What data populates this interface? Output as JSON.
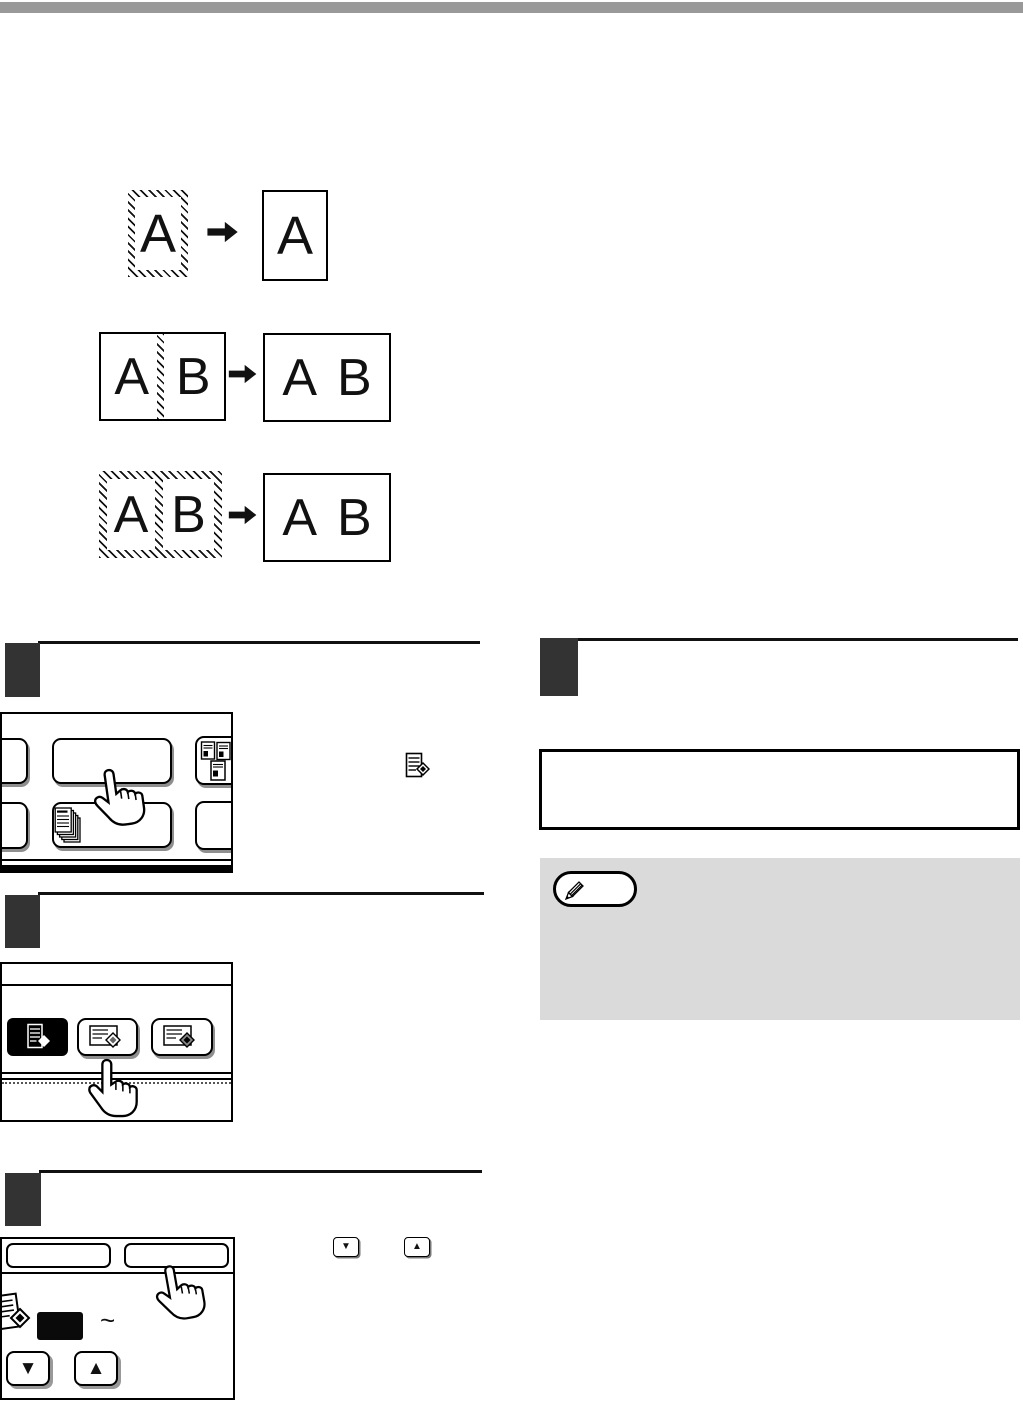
{
  "page": {
    "background": "#ffffff",
    "top_bar_color": "#999999",
    "step_marker_color": "#333333",
    "note_background": "#dadada",
    "ink": "#000000"
  },
  "diagrams": {
    "single_page": {
      "original_letter": "A",
      "copy_letter": "A"
    },
    "facing_pages": {
      "original_left": "A",
      "original_right": "B",
      "copy_left": "A",
      "copy_right": "B"
    },
    "book_spread": {
      "original_left": "A",
      "original_right": "B",
      "copy_left": "A",
      "copy_right": "B"
    }
  },
  "panel3": {
    "range_tilde": "~"
  },
  "glyphs": {
    "down_key": "▼",
    "up_key": "▲"
  },
  "icons": {
    "special_modes_icon": "page-with-diamond",
    "id_card_copy_icon": "three-id-cards",
    "document_stack_icon": "fanned-document-stack",
    "mode_black_button_icon": "page-with-diamond-inverted",
    "mode_button_2_icon": "landscape-page-with-diamond",
    "mode_button_3_icon": "landscape-page-with-filled-diamond",
    "note_icon": "pencil-in-capsule",
    "hand_cursor": "pointing-hand",
    "arrow_icon": "solid-right-arrow"
  }
}
